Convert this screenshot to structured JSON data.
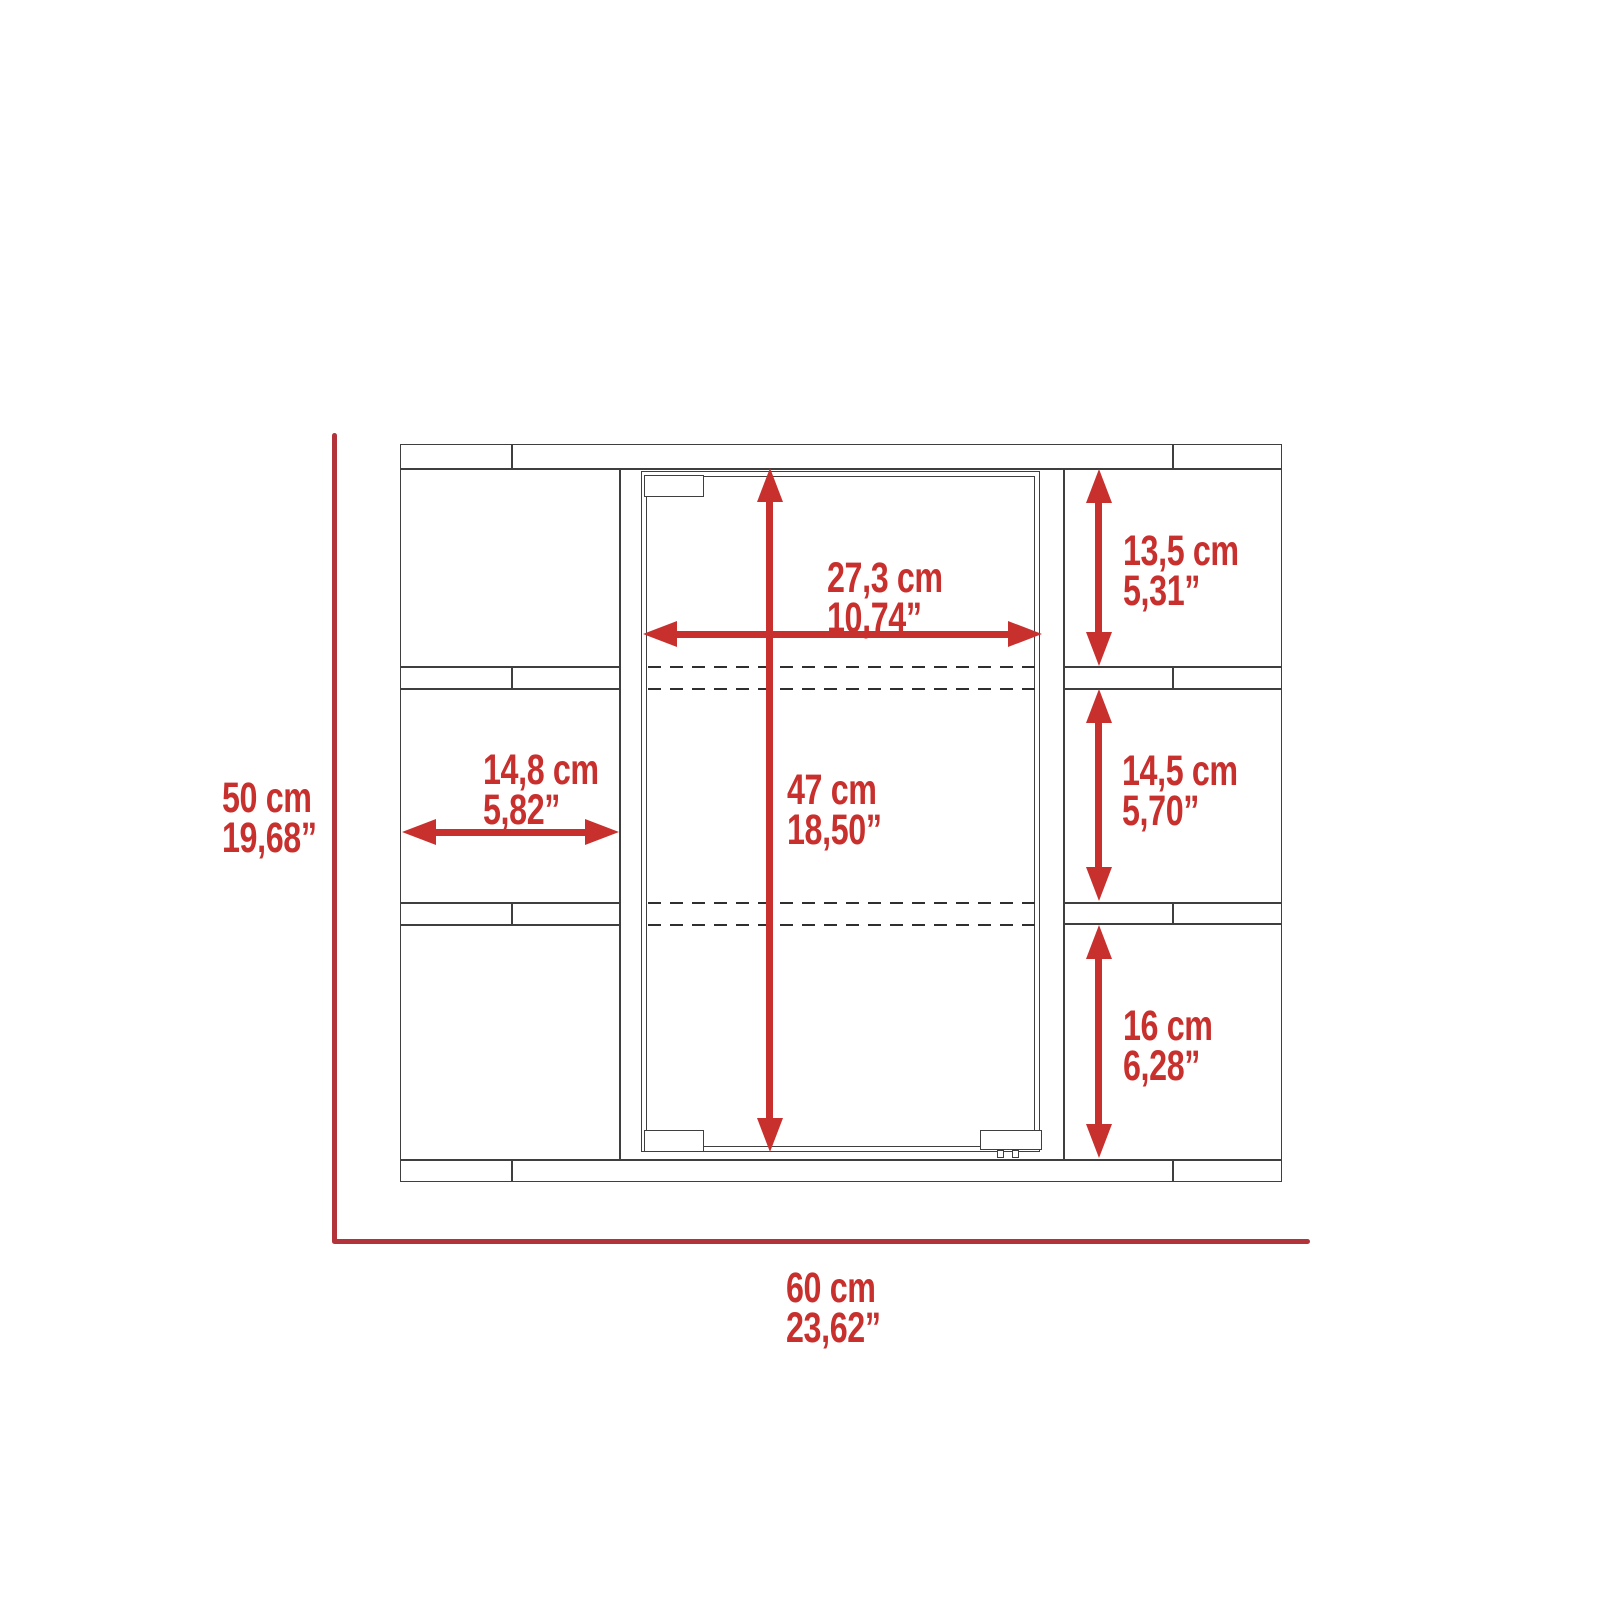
{
  "diagram": {
    "type": "furniture-dimension-drawing",
    "subject": "wall medicine cabinet with mirror door, front elevation",
    "colors": {
      "background": "#ffffff",
      "cabinet_outline": "#3f3f3f",
      "dimension_red": "#c8302e",
      "axis_red": "#b2333a"
    },
    "overall": {
      "height": {
        "metric": "50 cm",
        "imperial": "19,68”"
      },
      "width": {
        "metric": "60 cm",
        "imperial": "23,62”"
      }
    },
    "dimensions": [
      {
        "id": "door-width",
        "metric": "27,3 cm",
        "imperial": "10,74”"
      },
      {
        "id": "door-height",
        "metric": "47 cm",
        "imperial": "18,50”"
      },
      {
        "id": "left-shelf-width",
        "metric": "14,8 cm",
        "imperial": "5,82”"
      },
      {
        "id": "right-top-shelf-height",
        "metric": "13,5 cm",
        "imperial": "5,31”"
      },
      {
        "id": "right-middle-shelf-height",
        "metric": "14,5 cm",
        "imperial": "5,70”"
      },
      {
        "id": "right-bottom-shelf-height",
        "metric": "16 cm",
        "imperial": "6,28”"
      }
    ]
  }
}
